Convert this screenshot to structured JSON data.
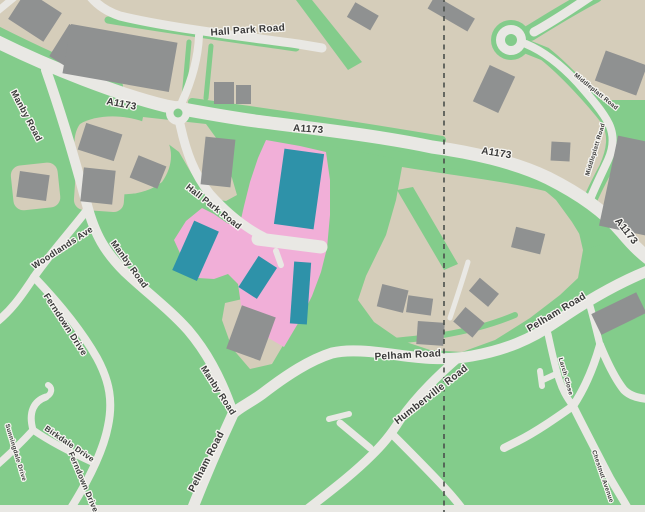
{
  "labels": {
    "a1173": "A1173",
    "hall_park_road": "Hall Park Road",
    "manby_road": "Manby Road",
    "woodlands_ave": "Woodlands Ave",
    "ferndown_drive": "Ferndown Drive",
    "birkdale_drive": "Birkdale Drive",
    "sunningdale_drive": "Sunningdale Drive",
    "pelham_road": "Pelham Road",
    "humberville_road": "Humberville Road",
    "middleplatt_road": "Middleplatt Road",
    "larch_close": "Larch Close",
    "chestnut_avenue": "Chestnut Avenue"
  },
  "colors": {
    "map_green": "#83CC8B",
    "land_beige": "#D5CDBA",
    "road_white": "#E9E8E4",
    "building_gray": "#8F9191",
    "site_pink": "#F1AFD8",
    "building_teal": "#2E92A9",
    "boundary_gray": "#4A4F4B",
    "label_text": "#393939",
    "label_halo": "#F6F5F1"
  }
}
